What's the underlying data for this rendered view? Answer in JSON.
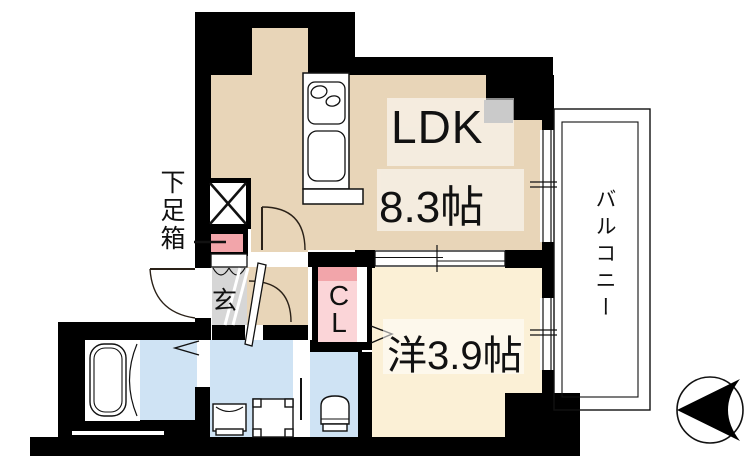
{
  "floorplan": {
    "labels": {
      "ldk": "LDK",
      "ldk_size": "8.3帖",
      "western_room": "洋3.9帖",
      "closet": "CL",
      "entrance": "玄",
      "shoe_cabinet": "下足箱",
      "balcony": "バルコニー"
    },
    "colors": {
      "wall": "#000000",
      "ldk_floor": "#e8d5b8",
      "western_floor": "#fbf0d6",
      "wet_area_floor": "#cfe3f4",
      "entrance_floor": "#d6d6d6",
      "closet_pink_light": "#fbd5d8",
      "closet_pink_dark": "#f2a5aa",
      "pillar_gray": "#8a8a8a"
    },
    "icons": {
      "kitchen": "stove-and-sink-icon",
      "bath": "bathtub-icon",
      "laundry": "washing-machine-icon",
      "washstand": "washbasin-icon",
      "toilet": "toilet-icon",
      "pipe_space": "crossed-box-icon",
      "compass": "north-arrow-icon"
    },
    "compass": {
      "arrow_points": "left"
    }
  }
}
